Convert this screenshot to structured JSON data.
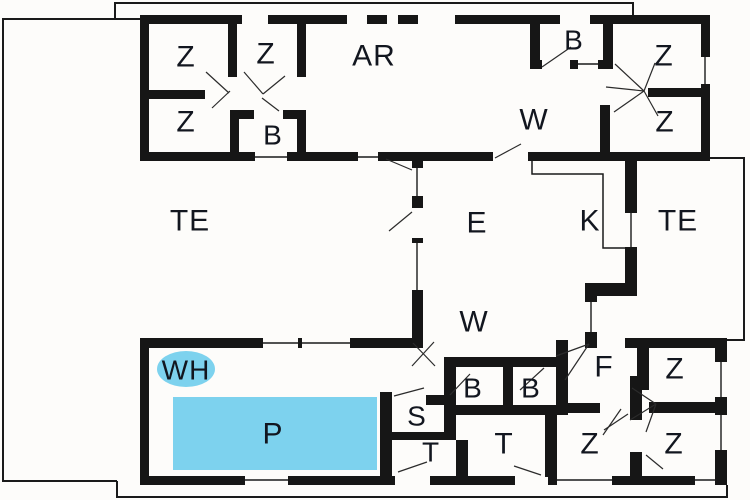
{
  "floor_plan": {
    "type": "holiday-house floor plan",
    "colors": {
      "wall": "#161616",
      "water": "#7dd2ee",
      "label": "#12161f",
      "background": "#fdfcfa",
      "thin_line": "#1a1a1a"
    },
    "labels": {
      "z1": "Z",
      "z2": "Z",
      "z3": "Z",
      "z4": "Z",
      "z5": "Z",
      "z6": "Z",
      "z7": "Z",
      "z8": "Z",
      "ar": "AR",
      "b1": "B",
      "b2": "B",
      "b3": "B",
      "b4": "B",
      "w1": "W",
      "w2": "W",
      "te1": "TE",
      "te2": "TE",
      "e": "E",
      "k": "K",
      "f": "F",
      "s": "S",
      "t1": "T",
      "t2": "T",
      "wh": "WH",
      "p": "P"
    }
  }
}
